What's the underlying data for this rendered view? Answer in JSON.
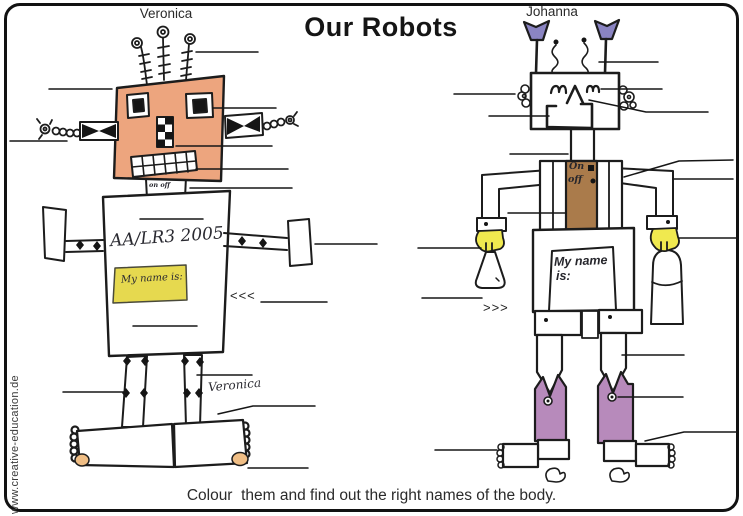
{
  "page": {
    "title": "Our Robots",
    "instruction": "Colour  them and find out the right names of the body.",
    "watermark": "www.creative-education.de"
  },
  "veronica": {
    "name": "Veronica",
    "body_code": "AA/LR3 2005",
    "name_tag": "My name is:",
    "neck_switch": "on off",
    "signature": "Veronica",
    "arrow": "<<<"
  },
  "johanna": {
    "name": "Johanna",
    "switch_on": "On",
    "switch_off": "off",
    "name_tag_line1": "My name",
    "name_tag_line2": "is:",
    "arrow": ">>>"
  },
  "colors": {
    "skin": "#eda57e",
    "sticky_note": "#e6d94f",
    "toe": "#f0be85",
    "funnel": "#8a84c2",
    "hand": "#f0e94f",
    "switch_panel": "#aa7b4b",
    "boot": "#b78abb",
    "ink": "#1c1c1c"
  }
}
